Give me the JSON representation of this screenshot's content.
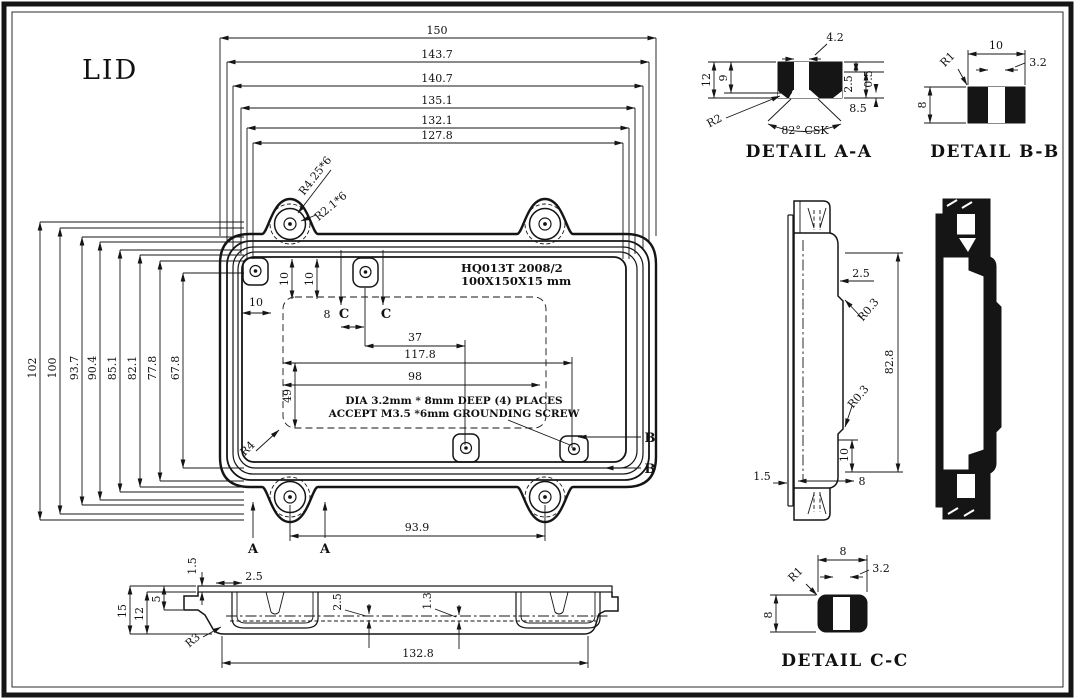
{
  "title": "LID",
  "colors": {
    "ink": "#151515",
    "bg": "#ffffff"
  },
  "plan": {
    "dims_top": [
      "150",
      "143.7",
      "140.7",
      "135.1",
      "132.1",
      "127.8"
    ],
    "dims_left": [
      "102",
      "100",
      "93.7",
      "90.4",
      "85.1",
      "82.1",
      "77.8",
      "67.8"
    ],
    "part_line1": "HQ013T 2008/2",
    "part_line2": "100X150X15 mm",
    "note_line1": "DIA 3.2mm * 8mm DEEP (4) PLACES",
    "note_line2": "ACCEPT M3.5 *6mm GROUNDING SCREW",
    "callout_lug_outer": "R4.25*6",
    "callout_lug_inner": "R2.1*6",
    "callout_corner": "R4",
    "dim_10a": "10",
    "dim_10b": "10",
    "dim_10c": "10",
    "dim_8": "8",
    "dim_37": "37",
    "dim_117": "117.8",
    "dim_98": "98",
    "dim_49": "49",
    "dim_939": "93.9",
    "sec_a": "A",
    "sec_b": "B",
    "sec_c": "C"
  },
  "detail_aa": {
    "title": "DETAIL A-A",
    "dim_top": "4.2",
    "dim_left": "12",
    "dim_left2": "9",
    "dim_r1": "2.5",
    "dim_r2": "0.5",
    "dim_r3": "8.5",
    "radius": "R2",
    "csk": "82° CSK"
  },
  "detail_bb": {
    "title": "DETAIL B-B",
    "dim_w": "10",
    "dim_slot": "3.2",
    "dim_h": "8",
    "radius": "R1"
  },
  "detail_cc": {
    "title": "DETAIL C-C",
    "dim_w": "8",
    "dim_slot": "3.2",
    "dim_h": "8",
    "radius": "R1"
  },
  "side": {
    "dim_wall": "2.5",
    "r_top": "R0.3",
    "dim_h": "82.8",
    "r_bot": "R0.3",
    "dim_10": "10",
    "dim_lip": "1.5",
    "dim_8": "8"
  },
  "bottom": {
    "dim_lip": "1.5",
    "dim_rim": "2.5",
    "dim_15": "15",
    "dim_12": "12",
    "dim_5": "5",
    "dim_t1": "2.5",
    "dim_t2": "1.3",
    "radius": "R3",
    "dim_w": "132.8"
  }
}
